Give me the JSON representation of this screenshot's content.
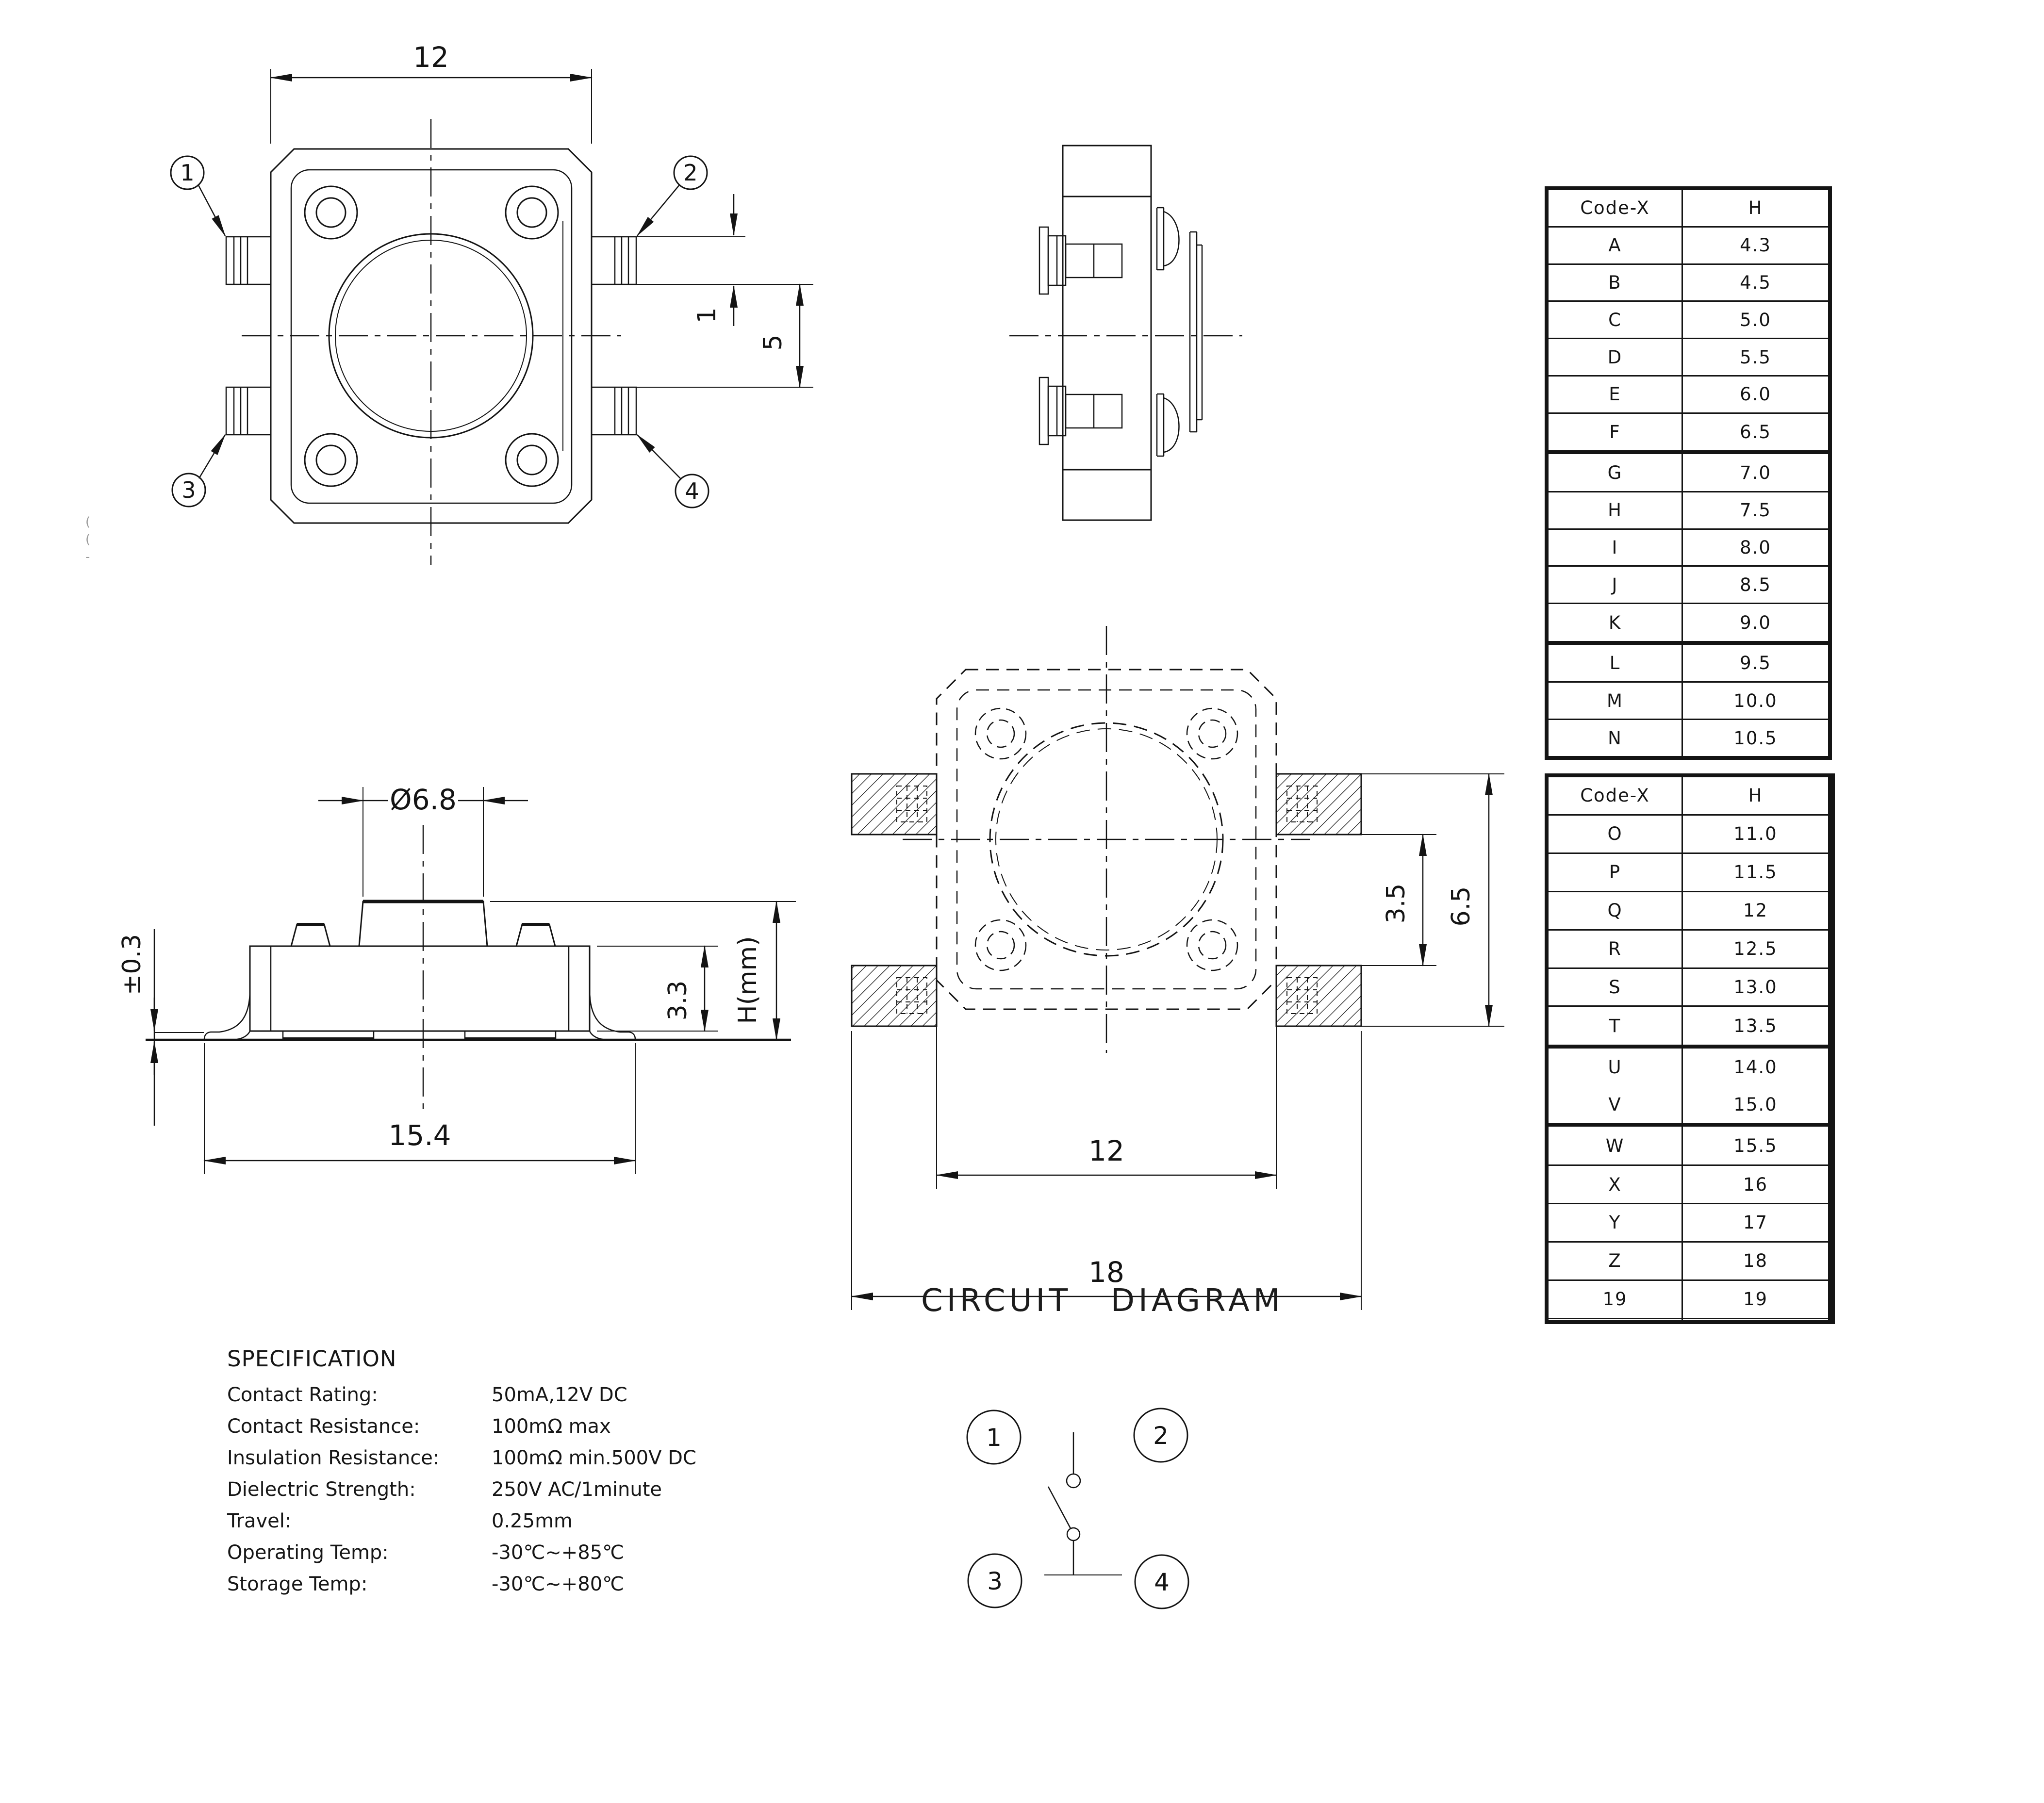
{
  "drawing": {
    "top_view": {
      "pin_labels": [
        "1",
        "2",
        "3",
        "4"
      ],
      "dims": {
        "width": "12",
        "pin_width": "1",
        "pin_gap": "5"
      }
    },
    "front_view": {
      "dims": {
        "stem_diameter": "Ø6.8",
        "overall_width": "15.4",
        "body_height": "3.3",
        "total_height": "H(mm)",
        "lead_thickness": "±0.3"
      }
    },
    "pcb_view": {
      "dims": {
        "body_width": "12",
        "overall_width": "18",
        "pad_gap": "3.5",
        "pad_span": "6.5"
      }
    },
    "circuit": {
      "title": "CIRCUIT DIAGRAM",
      "pin_labels": [
        "1",
        "2",
        "3",
        "4"
      ]
    }
  },
  "spec": {
    "title": "SPECIFICATION",
    "rows": [
      {
        "label": "Contact Rating:",
        "value": "50mA,12V DC"
      },
      {
        "label": "Contact Resistance:",
        "value": "100mΩ max"
      },
      {
        "label": "Insulation Resistance:",
        "value": "100mΩ min.500V DC"
      },
      {
        "label": "Dielectric Strength:",
        "value": "250V AC/1minute"
      },
      {
        "label": "Travel:",
        "value": "0.25mm"
      },
      {
        "label": "Operating Temp:",
        "value": "-30℃~+85℃"
      },
      {
        "label": "Storage Temp:",
        "value": "-30℃~+80℃"
      }
    ]
  },
  "tables": [
    {
      "headers": [
        "Code-X",
        "H"
      ],
      "rows": [
        [
          "A",
          "4.3"
        ],
        [
          "B",
          "4.5"
        ],
        [
          "C",
          "5.0"
        ],
        [
          "D",
          "5.5"
        ],
        [
          "E",
          "6.0"
        ],
        [
          "F",
          "6.5"
        ],
        [
          "G",
          "7.0"
        ],
        [
          "H",
          "7.5"
        ],
        [
          "I",
          "8.0"
        ],
        [
          "J",
          "8.5"
        ],
        [
          "K",
          "9.0"
        ],
        [
          "L",
          "9.5"
        ],
        [
          "M",
          "10.0"
        ],
        [
          "N",
          "10.5"
        ]
      ]
    },
    {
      "headers": [
        "Code-X",
        "H"
      ],
      "rows": [
        [
          "O",
          "11.0"
        ],
        [
          "P",
          "11.5"
        ],
        [
          "Q",
          "12"
        ],
        [
          "R",
          "12.5"
        ],
        [
          "S",
          "13.0"
        ],
        [
          "T",
          "13.5"
        ],
        [
          "U",
          "14.0"
        ],
        [
          "V",
          "15.0"
        ],
        [
          "W",
          "15.5"
        ],
        [
          "X",
          "16"
        ],
        [
          "Y",
          "17"
        ],
        [
          "Z",
          "18"
        ],
        [
          "19",
          "19"
        ],
        [
          "",
          ""
        ]
      ]
    }
  ],
  "artifacts": {
    "edge_marks": "(\n(\n-"
  }
}
